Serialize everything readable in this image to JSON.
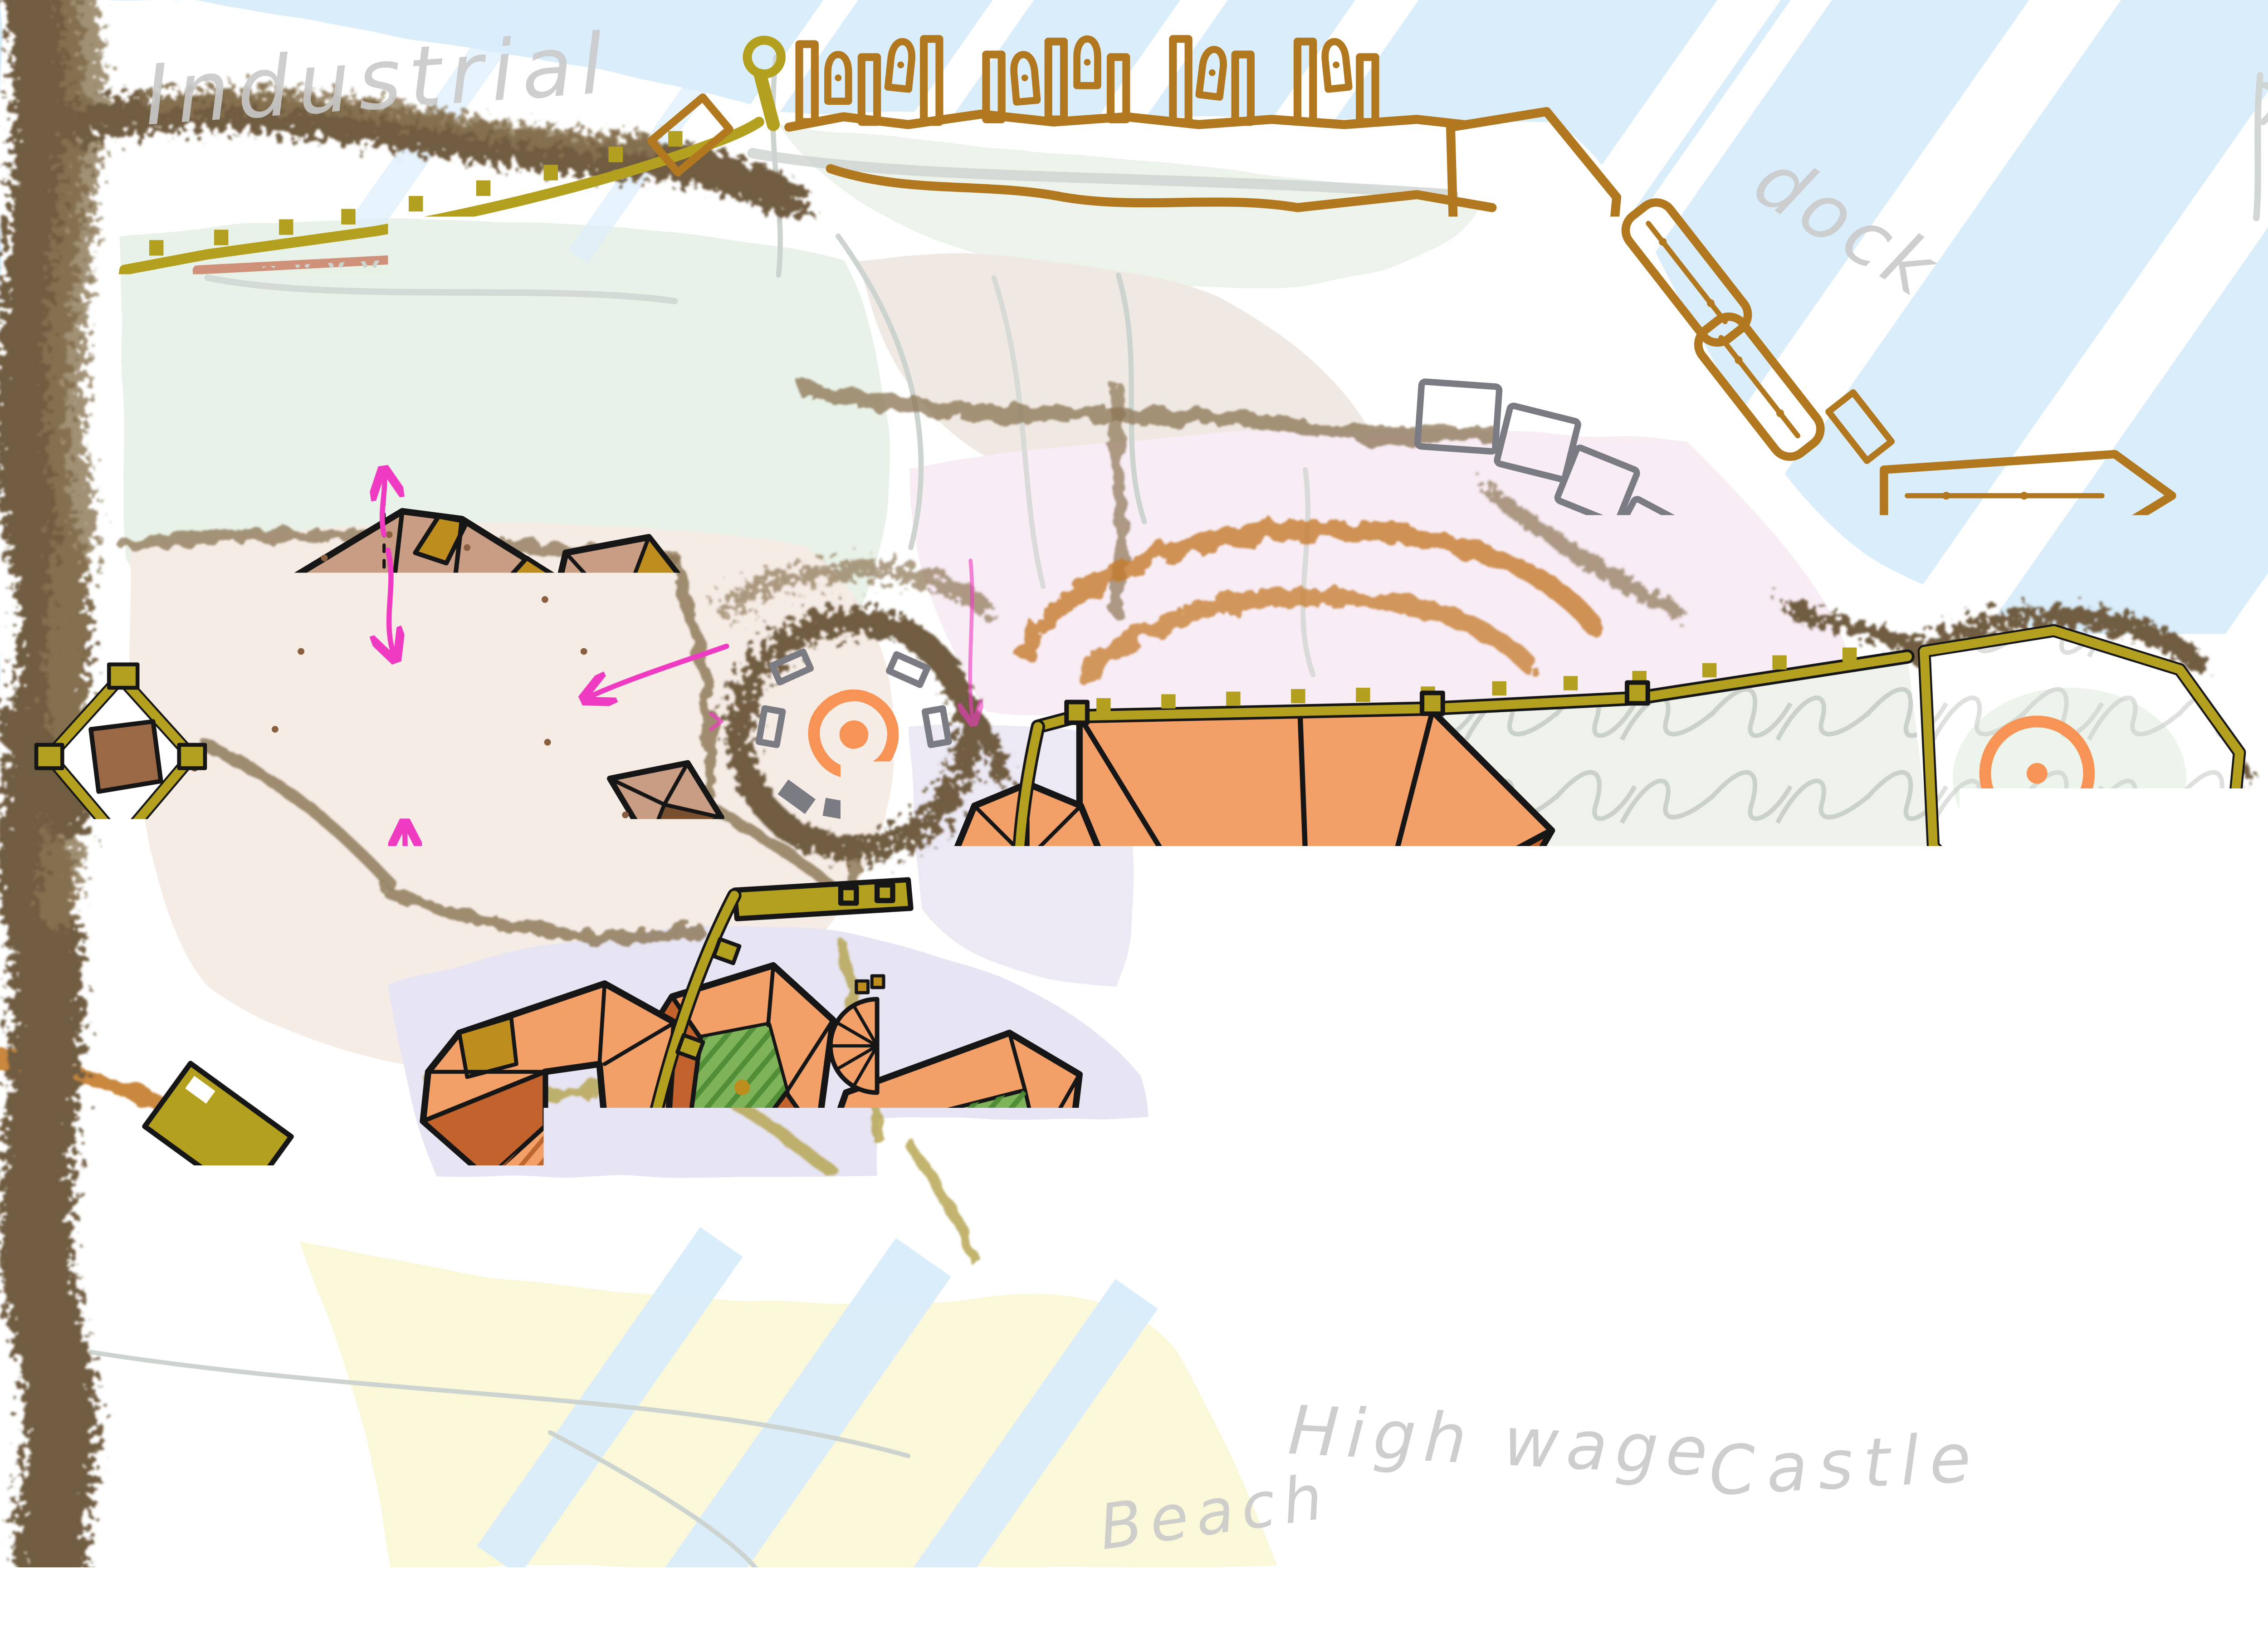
{
  "title": "Hand-drawn fantasy city district plan",
  "labels": {
    "industrial": {
      "text": "Industrial"
    },
    "dock": {
      "text": "dock"
    },
    "castle": {
      "text": "Castle"
    },
    "high_wage": {
      "text": "High wage"
    },
    "beach": {
      "text": "Beach"
    }
  },
  "colors": {
    "water": "#d9edfb",
    "paper": "#ffffff",
    "mint": "#e7f1e6",
    "linen": "#f0e9e3",
    "pale_pink": "#f8ecf5",
    "lavender": "#e7e4f3",
    "beach_sand": "#faf8d8",
    "forest": "#6f5c41",
    "forest_light": "#8a7452",
    "wall_olive": "#b3a01f",
    "dock_brown": "#b1781f",
    "outline": "#161616",
    "roof_tan": "#c89d83",
    "roof_brown": "#9a6845",
    "roof_dark": "#7a4f2f",
    "gold": "#bd8d1d",
    "orange_light": "#f2a068",
    "orange_dark": "#c2622d",
    "orange_line": "#f79455",
    "salmon": "#cf9179",
    "gray_building": "#7b7b84",
    "sketch_gray": "#cdd3cf",
    "magenta": "#ee3bc1",
    "garden_green": "#5c9b3e",
    "label_gray": "#c9c9c9",
    "path_khaki": "#b3a14b",
    "dirt_orange": "#c47a2a"
  }
}
